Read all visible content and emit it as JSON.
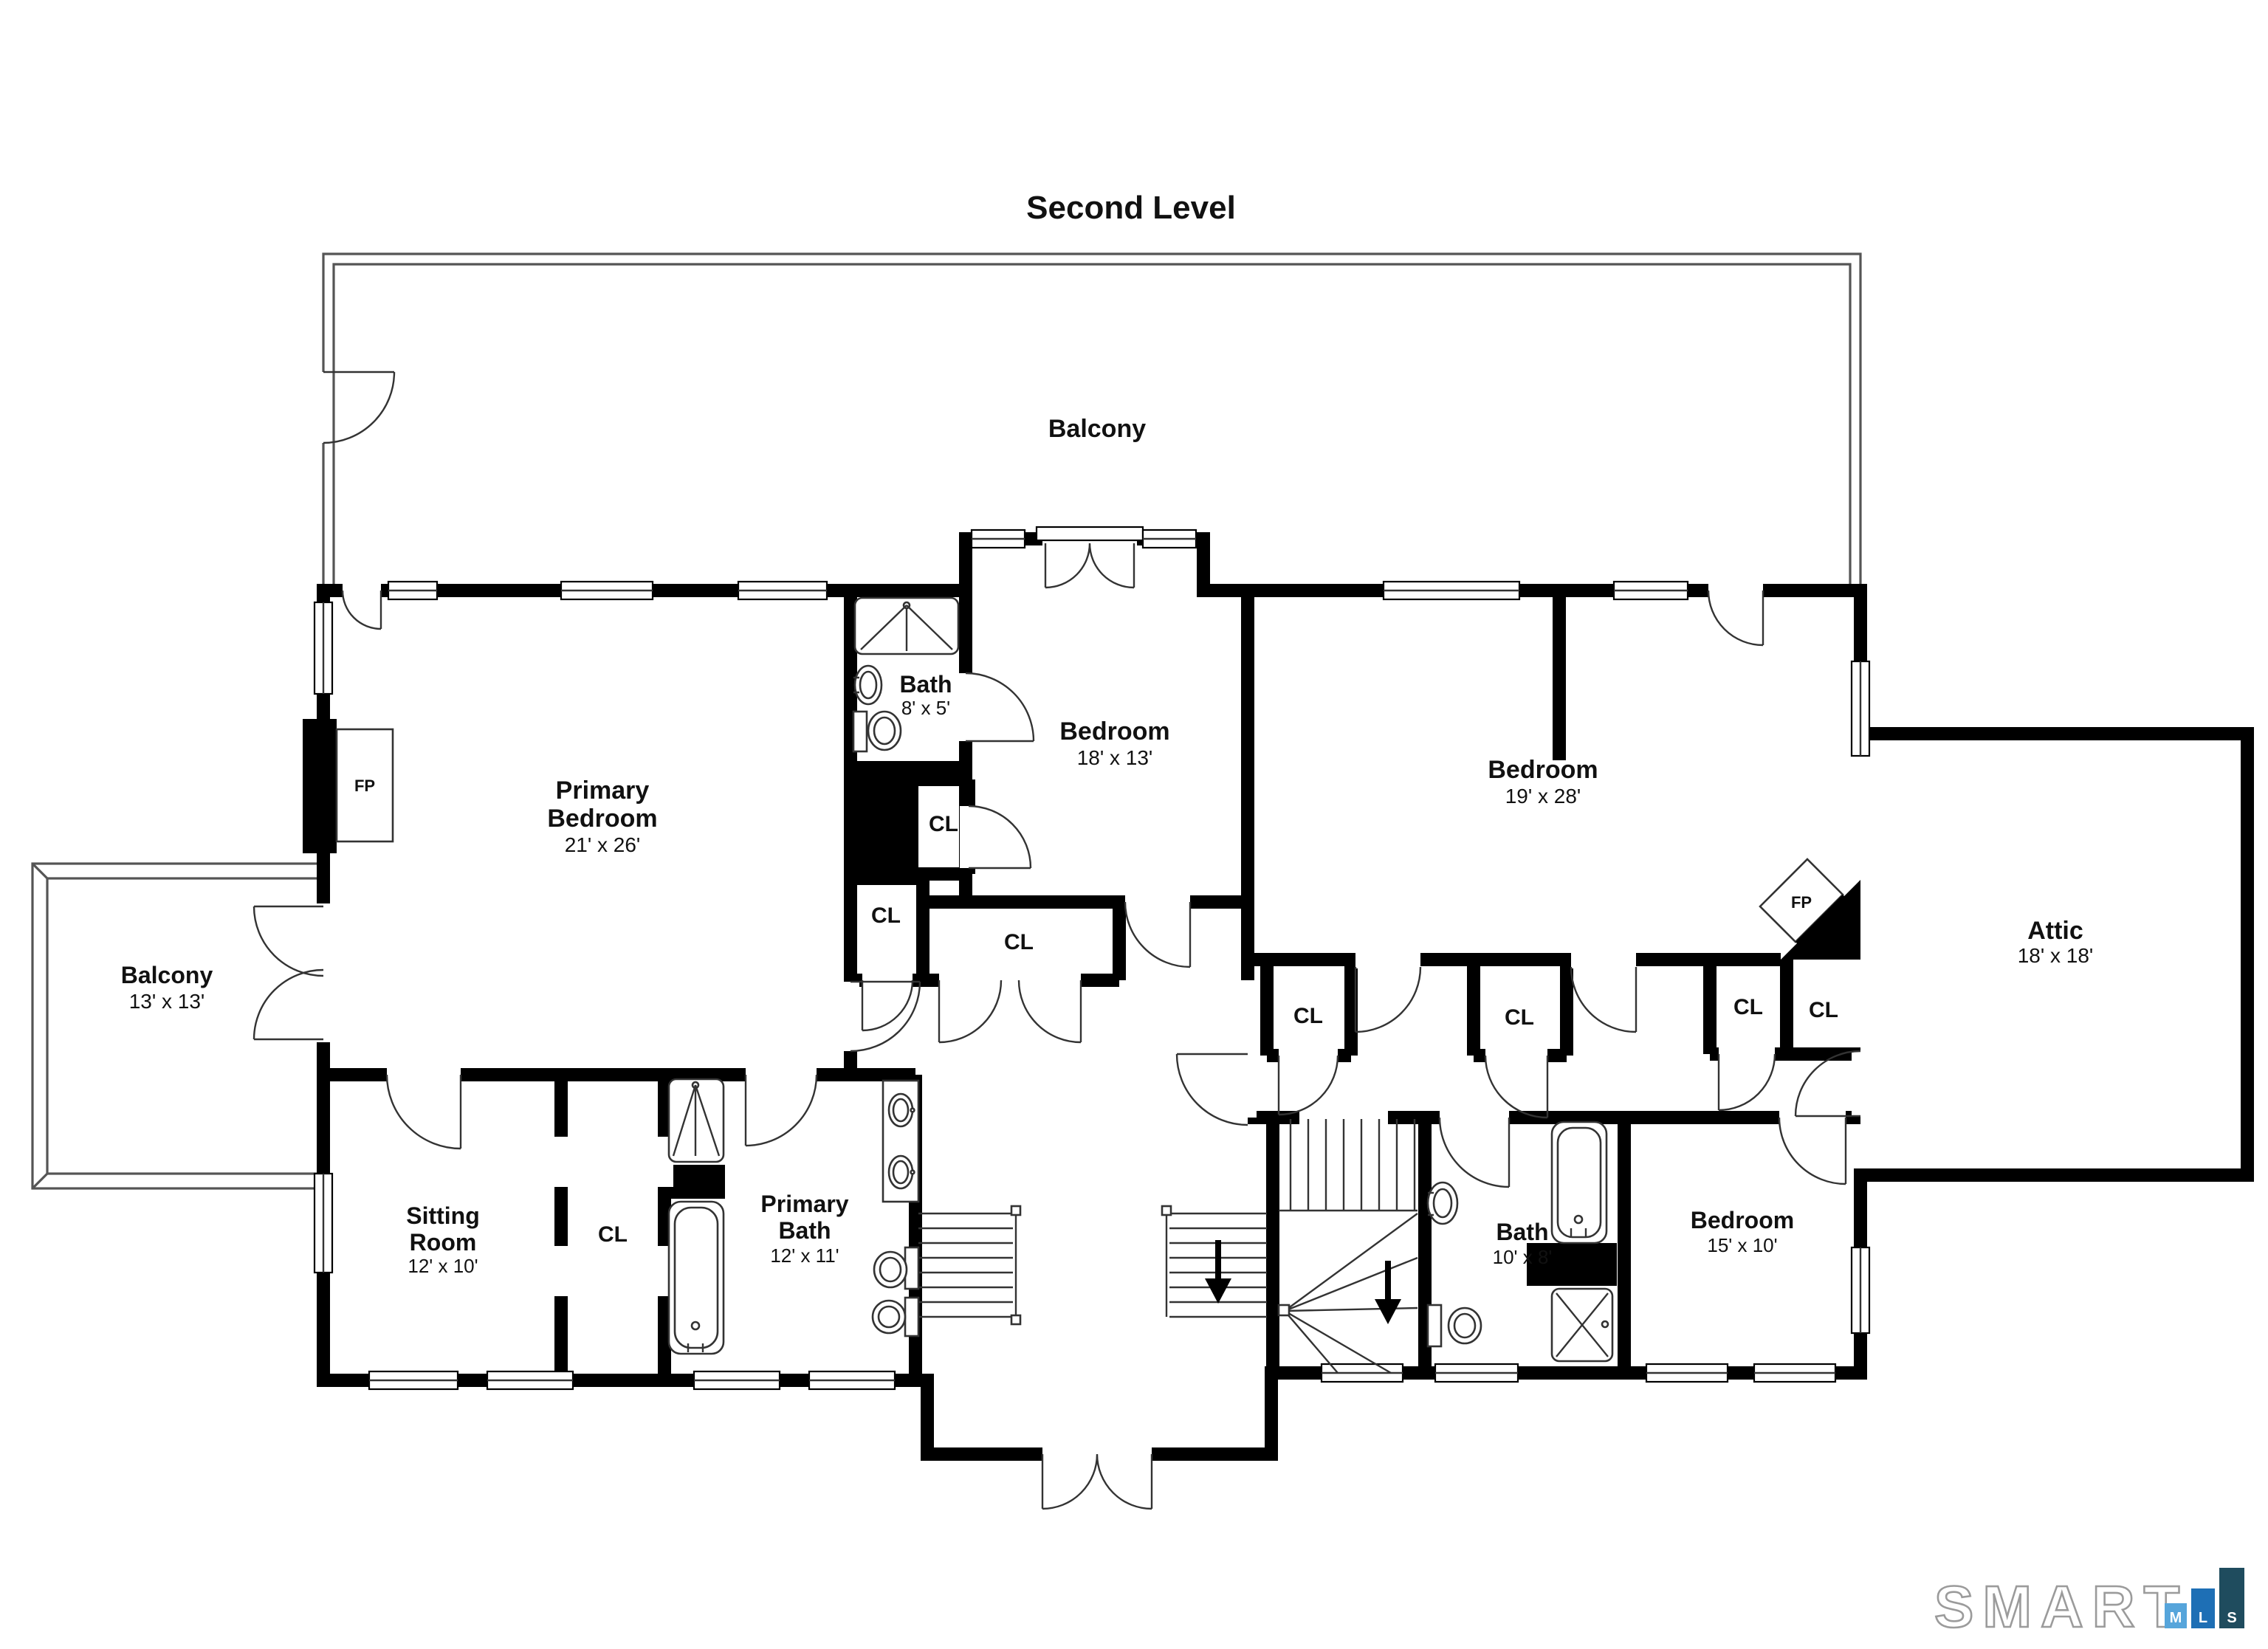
{
  "title": "Second Level",
  "rooms": {
    "balcony_top": {
      "label": "Balcony"
    },
    "balcony_left": {
      "label": "Balcony",
      "dims": "13' x 13'"
    },
    "primary_bedroom": {
      "line1": "Primary",
      "line2": "Bedroom",
      "dims": "21' x 26'"
    },
    "bath_small": {
      "label": "Bath",
      "dims": "8' x 5'"
    },
    "bedroom_18": {
      "label": "Bedroom",
      "dims": "18' x 13'"
    },
    "bedroom_19": {
      "label": "Bedroom",
      "dims": "19' x 28'"
    },
    "attic": {
      "label": "Attic",
      "dims": "18' x 18'"
    },
    "sitting_room": {
      "line1": "Sitting",
      "line2": "Room",
      "dims": "12' x 10'"
    },
    "primary_bath": {
      "line1": "Primary",
      "line2": "Bath",
      "dims": "12' x 11'"
    },
    "bath_10": {
      "label": "Bath",
      "dims": "10' x 8'"
    },
    "bedroom_15": {
      "label": "Bedroom",
      "dims": "15' x 10'"
    }
  },
  "closet": {
    "label": "CL"
  },
  "fireplace": {
    "label": "FP"
  },
  "colors": {
    "walls": "#000000",
    "logo_word_stroke": "#9B9B9B",
    "logo_m": "#56A5DB",
    "logo_l": "#1E6FB5",
    "logo_s": "#1F4C5E"
  },
  "logo": {
    "word": "SMART",
    "m": "M",
    "l": "L",
    "s": "S"
  }
}
